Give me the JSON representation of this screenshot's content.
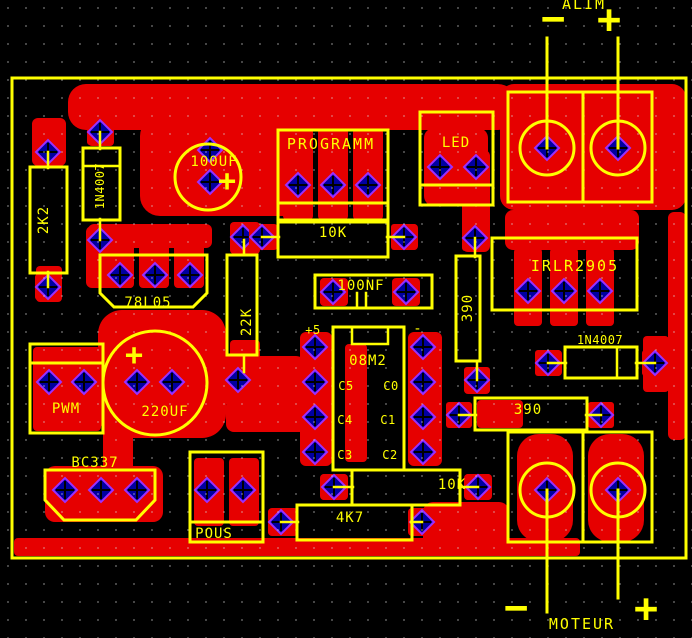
{
  "colors": {
    "background": "#000000",
    "copper": "#e60000",
    "silkscreen": "#ffff00",
    "pad_fill": "#0000a0",
    "pad_ring": "#9b30ff",
    "grid_dot": "#d8d8d8"
  },
  "annotations": {
    "alim": "ALIM",
    "moteur": "MOTEUR"
  },
  "marks": {
    "plus": "+",
    "minus": "−"
  },
  "labels": {
    "r2k2": "2K2",
    "d1": "1N4007",
    "c100uf": "100UF",
    "prog": "PROGRAMM",
    "r10k_a": "10K",
    "led": "LED",
    "reg78l05": "78L05",
    "r22k": "22K",
    "c100nf": "100NF",
    "mosfet": "IRLR2905",
    "d2": "1N4007",
    "r390v": "390",
    "r390h": "390",
    "ic": "08M2",
    "plus5": "+5",
    "ic_minus": "-",
    "c5": "C5",
    "c0": "C0",
    "c4": "C4",
    "c1": "C1",
    "c3": "C3",
    "c2": "C2",
    "pwm": "PWM",
    "c220uf": "220UF",
    "bc337": "BC337",
    "pous": "POUS",
    "r10k_b": "10K",
    "r4k7": "4K7"
  },
  "pads": [
    [
      48,
      152
    ],
    [
      48,
      287
    ],
    [
      100,
      132
    ],
    [
      100,
      240
    ],
    [
      210,
      150
    ],
    [
      210,
      182
    ],
    [
      298,
      185
    ],
    [
      333,
      185
    ],
    [
      368,
      185
    ],
    [
      440,
      167
    ],
    [
      476,
      167
    ],
    [
      547,
      148
    ],
    [
      618,
      148
    ],
    [
      243,
      237
    ],
    [
      262,
      237
    ],
    [
      404,
      237
    ],
    [
      120,
      275
    ],
    [
      155,
      275
    ],
    [
      190,
      275
    ],
    [
      333,
      292
    ],
    [
      406,
      292
    ],
    [
      475,
      238
    ],
    [
      528,
      291
    ],
    [
      564,
      291
    ],
    [
      600,
      291
    ],
    [
      548,
      363
    ],
    [
      655,
      363
    ],
    [
      477,
      380
    ],
    [
      459,
      415
    ],
    [
      601,
      415
    ],
    [
      315,
      347
    ],
    [
      315,
      382
    ],
    [
      315,
      417
    ],
    [
      315,
      452
    ],
    [
      423,
      347
    ],
    [
      423,
      382
    ],
    [
      423,
      417
    ],
    [
      423,
      452
    ],
    [
      49,
      382
    ],
    [
      84,
      382
    ],
    [
      137,
      382
    ],
    [
      172,
      382
    ],
    [
      238,
      380
    ],
    [
      65,
      490
    ],
    [
      101,
      490
    ],
    [
      137,
      490
    ],
    [
      207,
      490
    ],
    [
      243,
      490
    ],
    [
      334,
      487
    ],
    [
      478,
      487
    ],
    [
      281,
      522
    ],
    [
      422,
      522
    ],
    [
      547,
      490
    ],
    [
      618,
      490
    ]
  ]
}
